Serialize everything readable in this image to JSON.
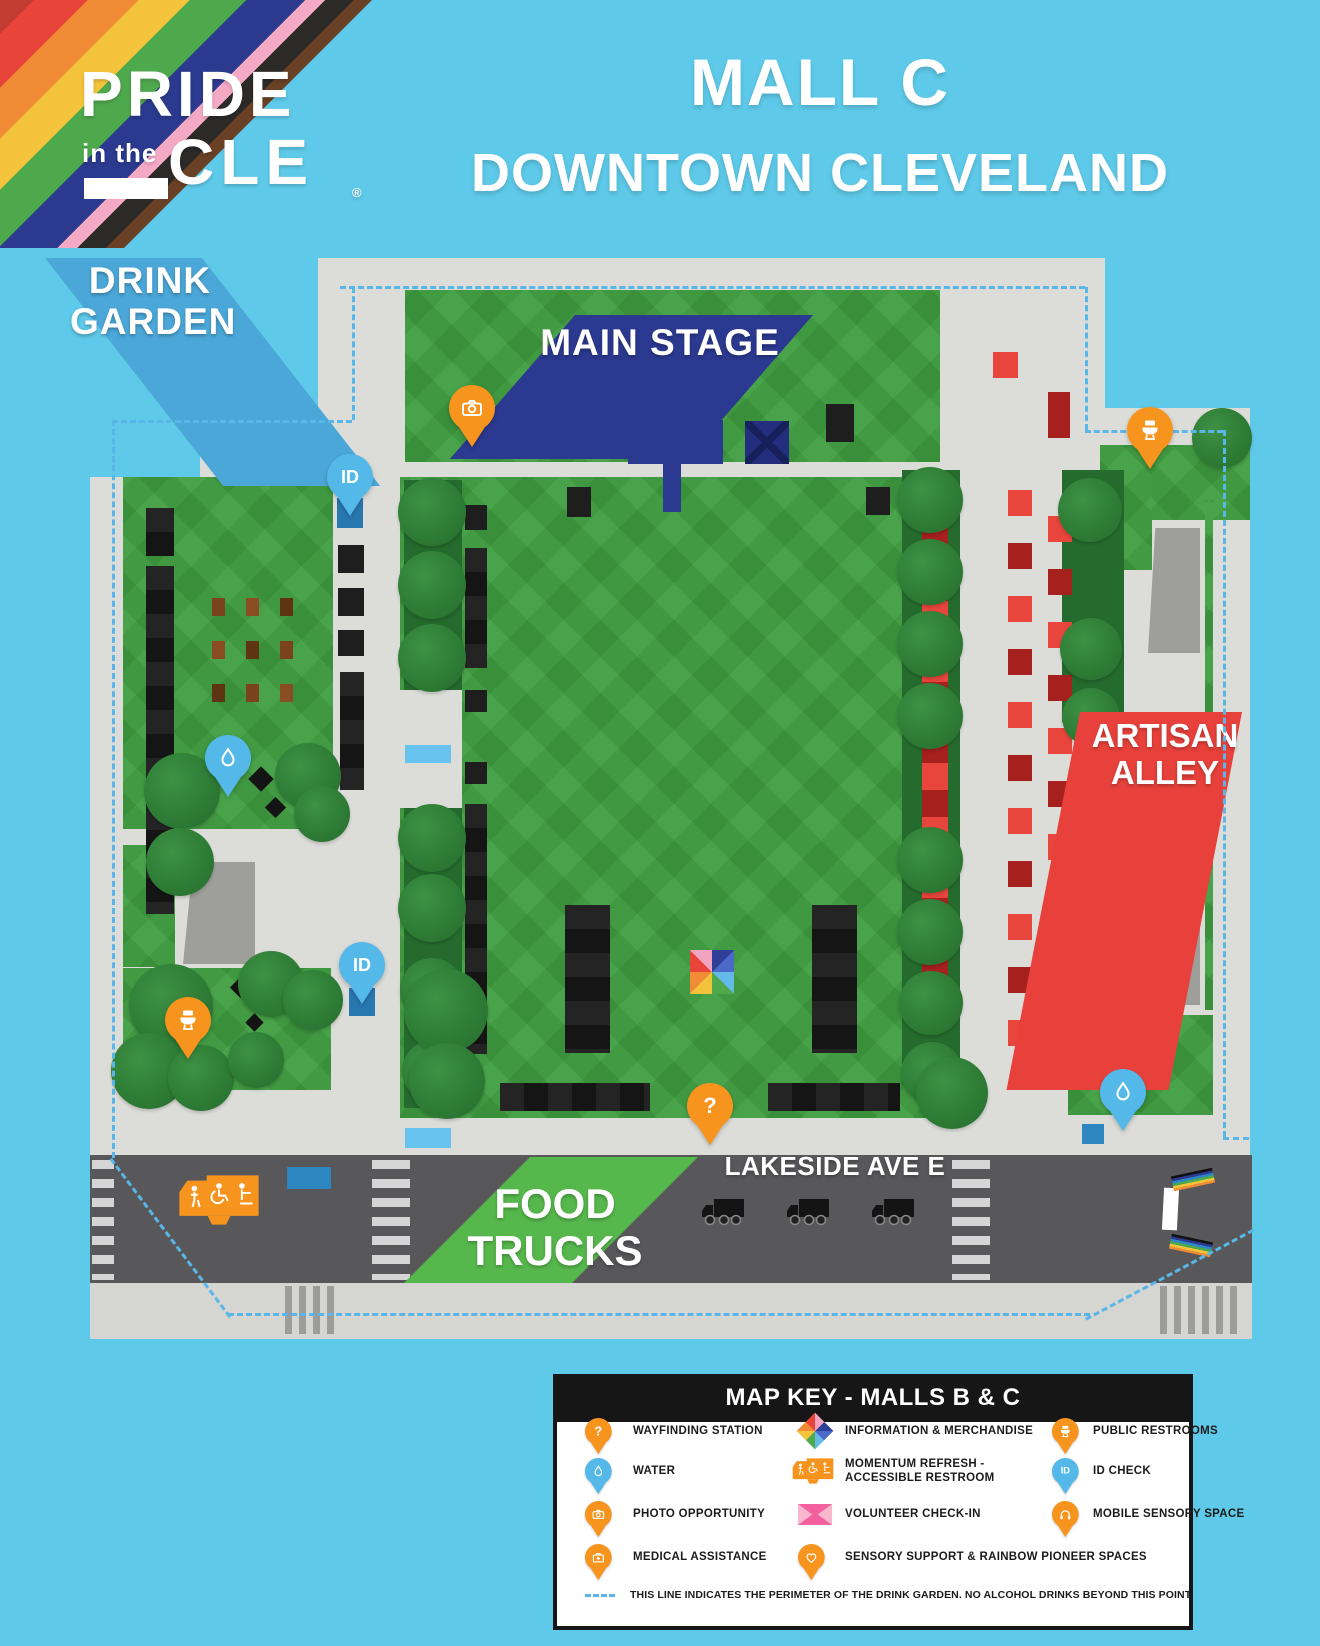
{
  "colors": {
    "sky": "#5EC9E9",
    "map_gray": "#DCDCD8",
    "road_gray": "#58585A",
    "lawn_green": "#49A34A",
    "tree_green": "#2E7D36",
    "booth_black": "#1E1E1E",
    "booth_red": "#E8453C",
    "booth_dark_red": "#A6201E",
    "booth_brown": "#7A431D",
    "pin_orange": "#F7941E",
    "pin_blue": "#54B8E8",
    "stage_navy": "#2B3990",
    "artisan_red": "#E8413B",
    "food_green": "#56B84C",
    "drink_garden_blue": "#4BA7D8",
    "volunteer_pink": "#F2609E",
    "perimeter_dash_blue": "#58B7E8"
  },
  "logo": {
    "word1": "PRIDE",
    "word2": "in the",
    "word3": "CLE",
    "trademark": "®"
  },
  "header": {
    "title_line1": "MALL C",
    "title_line2": "DOWNTOWN CLEVELAND"
  },
  "map": {
    "areas": {
      "drink_garden_line1": "DRINK",
      "drink_garden_line2": "GARDEN",
      "main_stage": "MAIN STAGE",
      "artisan_alley_line1": "ARTISAN",
      "artisan_alley_line2": "ALLEY",
      "food_trucks_line1": "FOOD",
      "food_trucks_line2": "TRUCKS",
      "street_name": "LAKESIDE AVE E"
    },
    "pins": {
      "id_check": "ID",
      "wayfinding": "?"
    }
  },
  "key": {
    "title": "MAP KEY - MALLS B & C",
    "columns": [
      {
        "items": [
          {
            "icon": "wayfinding-pin",
            "label": "WAYFINDING STATION"
          },
          {
            "icon": "water-pin",
            "label": "WATER"
          },
          {
            "icon": "photo-pin",
            "label": "PHOTO OPPORTUNITY"
          },
          {
            "icon": "medical-pin",
            "label": "MEDICAL ASSISTANCE"
          }
        ]
      },
      {
        "items": [
          {
            "icon": "information-pinwheel",
            "label": "INFORMATION & MERCHANDISE"
          },
          {
            "icon": "momentum-refresh-truck",
            "label_line1": "MOMENTUM REFRESH -",
            "label_line2": "ACCESSIBLE RESTROOM"
          },
          {
            "icon": "volunteer-bow",
            "label": "VOLUNTEER CHECK-IN"
          },
          {
            "icon": "sensory-heart-pin",
            "label": "SENSORY SUPPORT & RAINBOW PIONEER SPACES"
          }
        ]
      },
      {
        "items": [
          {
            "icon": "restroom-pin",
            "label": "PUBLIC RESTROOMS"
          },
          {
            "icon": "id-pin",
            "label": "ID CHECK"
          },
          {
            "icon": "mobile-sensory-pin",
            "label": "MOBILE SENSORY SPACE"
          }
        ]
      }
    ],
    "note": "THIS LINE INDICATES THE PERIMETER OF THE DRINK GARDEN. NO ALCOHOL DRINKS BEYOND THIS POINT."
  }
}
